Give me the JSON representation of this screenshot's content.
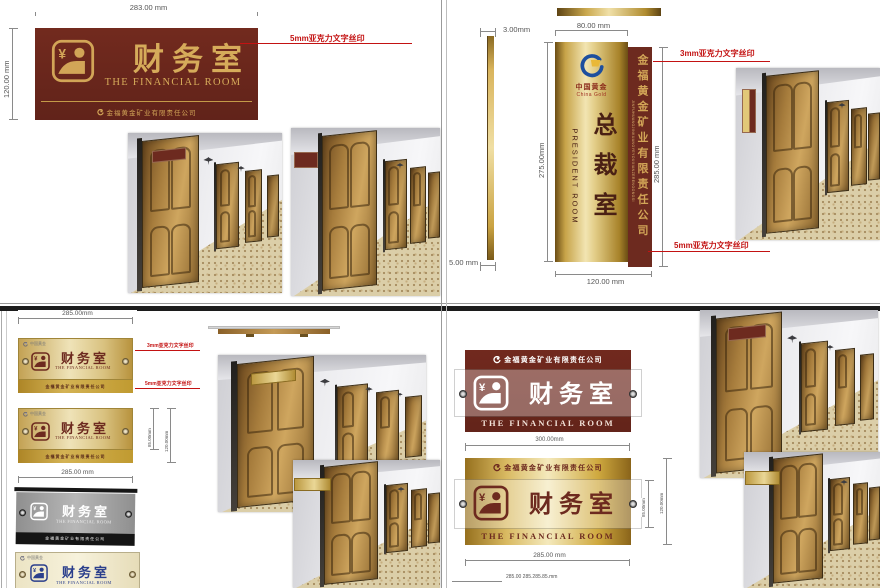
{
  "common": {
    "room_cn": "财务室",
    "room_en": "THE FINANCIAL ROOM",
    "company": "金福黄金矿业有限责任公司",
    "company_pinyin": "JINFUHUANGJINKUANGYEYOUXIANZERENGONGSI",
    "logo_cn": "中国黄金",
    "logo_en": "China Gold"
  },
  "colors": {
    "maroon": "#6d2a1f",
    "gold": "#d2a557",
    "annotation_red": "#c31212",
    "gray_sign": "#9a9a9a",
    "blue_sign_text": "#2b3f8c"
  },
  "q1": {
    "dim_width": "283.00 mm",
    "dim_height": "120.00 mm",
    "note": "5mm亚克力文字丝印"
  },
  "q2": {
    "title_cn": "总裁室",
    "title_en": "PRESIDENT ROOM",
    "dim_top_thickness": "3.00mm",
    "dim_bottom_thickness": "5.00 mm",
    "dim_panel_width": "80.00 mm",
    "dim_panel_height": "275.00mm",
    "dim_total_height": "285.00 mm",
    "dim_total_width": "120.00 mm",
    "note_top": "3mm亚克力文字丝印",
    "note_bottom": "5mm亚克力文字丝印"
  },
  "q3": {
    "dim_top": "285.00mm",
    "dim_bottom": "285.00 mm",
    "dim_side_inner": "85.00mm",
    "dim_side_outer": "120.00mm",
    "note1": "3mm亚克力文字丝印",
    "note2": "5mm亚克力文字丝印"
  },
  "q4": {
    "dim_top": "300.00mm",
    "dim_right_inner": "85.00mm",
    "dim_right_outer": "120.00mm",
    "dim_bottom": "285.00 mm",
    "dim_bottom_partial": "285.00 285.285.85.mm"
  }
}
